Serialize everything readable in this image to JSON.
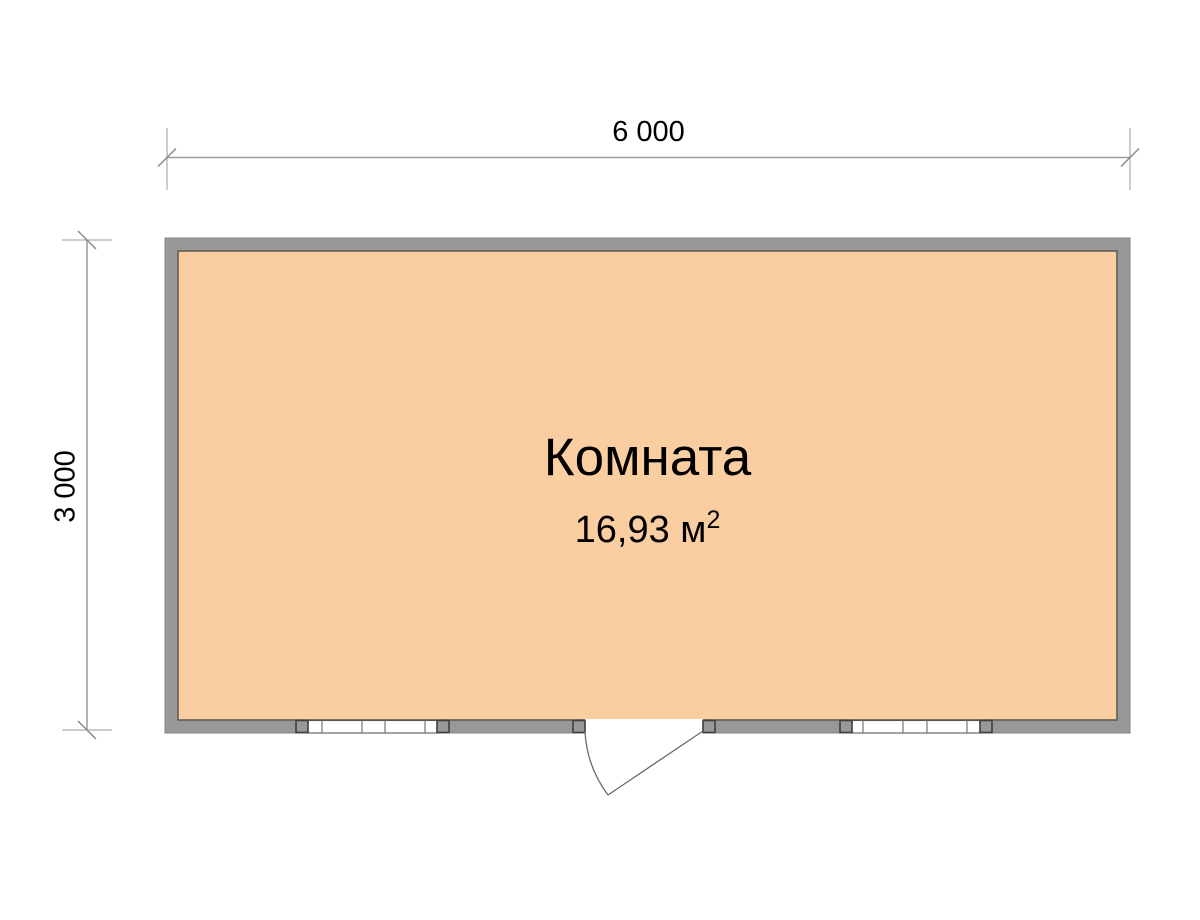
{
  "plan": {
    "room": {
      "name": "Комната",
      "area": "16,93 м",
      "area_exponent": "2"
    },
    "dimensions": {
      "width": "6 000",
      "height": "3 000"
    },
    "colors": {
      "floor": "#FBCEA1",
      "wall": "#989898",
      "wall_edge": "#5F5F58",
      "dim_line": "#9B9B9B",
      "draw_line": "#6A6A6A",
      "text": "#000000"
    }
  }
}
